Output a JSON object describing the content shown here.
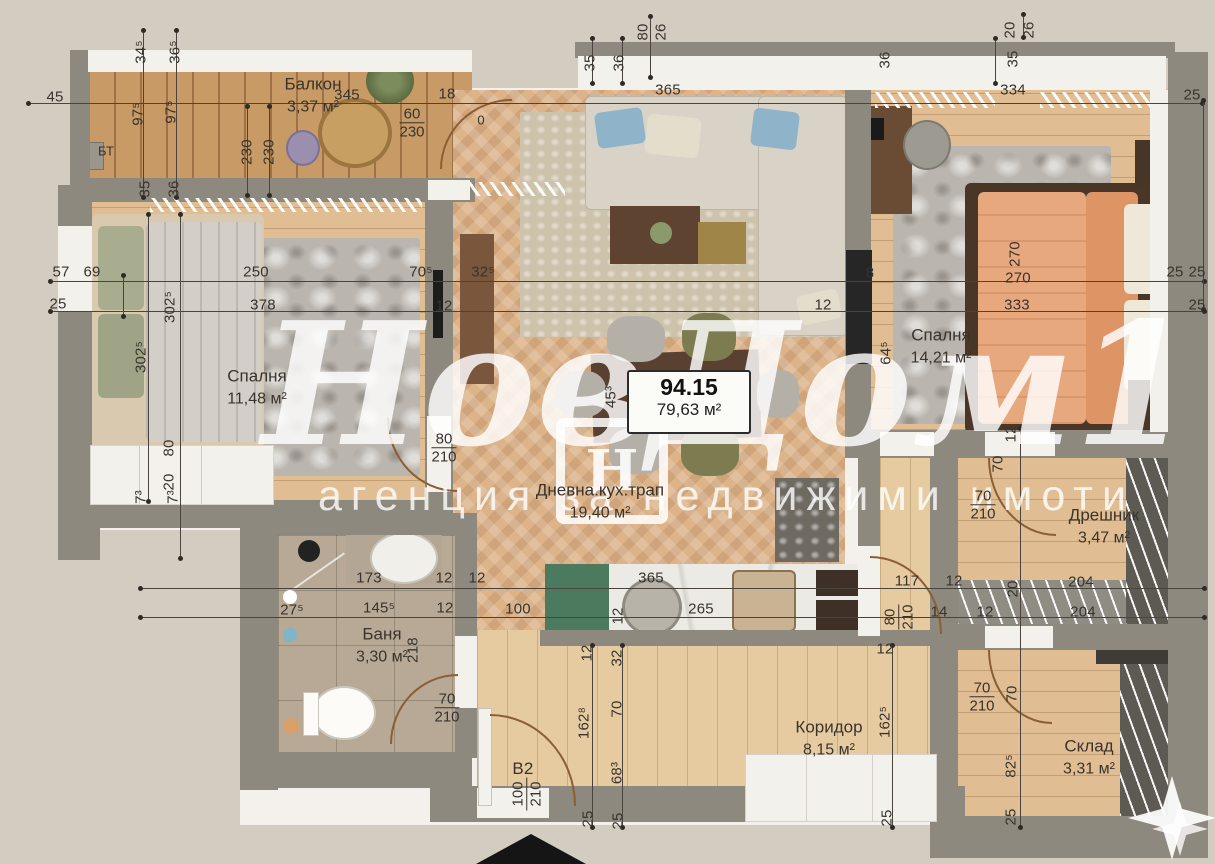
{
  "watermark": {
    "brand_left": "Нов",
    "brand_right": "Дом1",
    "logo_letter": "Н",
    "tagline": "агенция за недвижими имоти"
  },
  "summary": {
    "total": "94.15",
    "net": "79,63 м²"
  },
  "entrance": {
    "tag": "B2"
  },
  "rooms": [
    {
      "id": "balcony",
      "name": "Балкон",
      "area": "3,37 м²",
      "x": 313,
      "y": 96
    },
    {
      "id": "bedroom-left",
      "name": "Спалня",
      "area": "11,48 м²",
      "x": 257,
      "y": 388
    },
    {
      "id": "living",
      "name": "Дневна.кух.трап",
      "area": "19,40 м²",
      "x": 600,
      "y": 502
    },
    {
      "id": "bedroom-right",
      "name": "Спалня",
      "area": "14,21 м²",
      "x": 941,
      "y": 347
    },
    {
      "id": "bathroom",
      "name": "Баня",
      "area": "3,30 м²",
      "x": 382,
      "y": 646
    },
    {
      "id": "corridor",
      "name": "Коридор",
      "area": "8,15 м²",
      "x": 829,
      "y": 739
    },
    {
      "id": "closet",
      "name": "Дрешник",
      "area": "3,47 м²",
      "x": 1104,
      "y": 527
    },
    {
      "id": "storage",
      "name": "Склад",
      "area": "3,31 м²",
      "x": 1089,
      "y": 758
    }
  ],
  "annotations": [
    {
      "t": "БТ",
      "x": 106,
      "y": 151
    },
    {
      "t": "0",
      "x": 481,
      "y": 120
    }
  ],
  "dims": [
    {
      "t": "45",
      "x": 55,
      "y": 97
    },
    {
      "t": "345",
      "x": 347,
      "y": 95
    },
    {
      "t": "18",
      "x": 447,
      "y": 94
    },
    {
      "t": "365",
      "x": 668,
      "y": 90
    },
    {
      "t": "334",
      "x": 1013,
      "y": 90
    },
    {
      "t": "25",
      "x": 1192,
      "y": 95
    },
    {
      "t": "34⁵",
      "x": 141,
      "y": 52,
      "r": 1
    },
    {
      "t": "36⁵",
      "x": 175,
      "y": 52,
      "r": 1
    },
    {
      "t": "97⁵",
      "x": 138,
      "y": 114,
      "r": 1
    },
    {
      "t": "97⁵",
      "x": 171,
      "y": 112,
      "r": 1
    },
    {
      "t": "230",
      "x": 247,
      "y": 152,
      "r": 1
    },
    {
      "t": "230",
      "x": 269,
      "y": 152,
      "r": 1
    },
    {
      "t": "35",
      "x": 145,
      "y": 189,
      "r": 1
    },
    {
      "t": "36",
      "x": 174,
      "y": 189,
      "r": 1
    },
    {
      "t": "80",
      "x": 643,
      "y": 32,
      "r": 1
    },
    {
      "t": "26",
      "x": 661,
      "y": 32,
      "r": 1
    },
    {
      "t": "35",
      "x": 590,
      "y": 63,
      "r": 1
    },
    {
      "t": "36",
      "x": 619,
      "y": 63,
      "r": 1
    },
    {
      "t": "20",
      "x": 1010,
      "y": 30,
      "r": 1
    },
    {
      "t": "26",
      "x": 1029,
      "y": 30,
      "r": 1
    },
    {
      "t": "35",
      "x": 1013,
      "y": 59,
      "r": 1
    },
    {
      "t": "36",
      "x": 885,
      "y": 60,
      "r": 1
    },
    {
      "t": "57",
      "x": 61,
      "y": 272
    },
    {
      "t": "25",
      "x": 58,
      "y": 304
    },
    {
      "t": "69",
      "x": 92,
      "y": 272
    },
    {
      "t": "250",
      "x": 256,
      "y": 272
    },
    {
      "t": "378",
      "x": 263,
      "y": 305
    },
    {
      "t": "302⁵",
      "x": 170,
      "y": 307,
      "r": 1
    },
    {
      "t": "302⁵",
      "x": 141,
      "y": 357,
      "r": 1
    },
    {
      "t": "70⁵",
      "x": 421,
      "y": 272
    },
    {
      "t": "32⁵",
      "x": 483,
      "y": 272
    },
    {
      "t": "12",
      "x": 444,
      "y": 306
    },
    {
      "t": "80",
      "x": 169,
      "y": 448,
      "r": 1
    },
    {
      "t": "20",
      "x": 169,
      "y": 482,
      "r": 1
    },
    {
      "t": "7³",
      "x": 141,
      "y": 497,
      "r": 1
    },
    {
      "t": "7³",
      "x": 173,
      "y": 497,
      "r": 1
    },
    {
      "t": "173",
      "x": 369,
      "y": 578
    },
    {
      "t": "12",
      "x": 444,
      "y": 578
    },
    {
      "t": "12",
      "x": 477,
      "y": 578
    },
    {
      "t": "27⁵",
      "x": 292,
      "y": 610
    },
    {
      "t": "145⁵",
      "x": 379,
      "y": 608
    },
    {
      "t": "12",
      "x": 445,
      "y": 608
    },
    {
      "t": "100",
      "x": 518,
      "y": 609
    },
    {
      "t": "218",
      "x": 413,
      "y": 650,
      "r": 1
    },
    {
      "t": "365",
      "x": 651,
      "y": 578
    },
    {
      "t": "265",
      "x": 701,
      "y": 609
    },
    {
      "t": "12",
      "x": 827,
      "y": 583
    },
    {
      "t": "12",
      "x": 618,
      "y": 616,
      "r": 1
    },
    {
      "t": "12",
      "x": 587,
      "y": 653,
      "r": 1
    },
    {
      "t": "32",
      "x": 617,
      "y": 658,
      "r": 1
    },
    {
      "t": "70",
      "x": 617,
      "y": 709,
      "r": 1
    },
    {
      "t": "162⁸",
      "x": 584,
      "y": 723,
      "r": 1
    },
    {
      "t": "68³",
      "x": 617,
      "y": 773,
      "r": 1
    },
    {
      "t": "25",
      "x": 588,
      "y": 819,
      "r": 1
    },
    {
      "t": "25",
      "x": 618,
      "y": 821,
      "r": 1
    },
    {
      "t": "117",
      "x": 907,
      "y": 581
    },
    {
      "t": "12",
      "x": 954,
      "y": 581
    },
    {
      "t": "14",
      "x": 939,
      "y": 612
    },
    {
      "t": "12",
      "x": 985,
      "y": 612
    },
    {
      "t": "204",
      "x": 1081,
      "y": 582
    },
    {
      "t": "204",
      "x": 1083,
      "y": 612
    },
    {
      "t": "20",
      "x": 1013,
      "y": 589,
      "r": 1
    },
    {
      "t": "12",
      "x": 885,
      "y": 649
    },
    {
      "t": "12",
      "x": 1011,
      "y": 434,
      "r": 1
    },
    {
      "t": "70",
      "x": 998,
      "y": 464,
      "r": 1
    },
    {
      "t": "45³",
      "x": 611,
      "y": 397,
      "r": 1
    },
    {
      "t": "270",
      "x": 1015,
      "y": 254,
      "r": 1
    },
    {
      "t": "270",
      "x": 1018,
      "y": 278
    },
    {
      "t": "333",
      "x": 1017,
      "y": 305
    },
    {
      "t": "8",
      "x": 870,
      "y": 273
    },
    {
      "t": "12",
      "x": 823,
      "y": 305
    },
    {
      "t": "64⁵",
      "x": 886,
      "y": 353,
      "r": 1
    },
    {
      "t": "25",
      "x": 1175,
      "y": 272
    },
    {
      "t": "25",
      "x": 1197,
      "y": 272
    },
    {
      "t": "25",
      "x": 1197,
      "y": 305
    },
    {
      "t": "70",
      "x": 1012,
      "y": 694,
      "r": 1
    },
    {
      "t": "82⁵",
      "x": 1011,
      "y": 766,
      "r": 1
    },
    {
      "t": "25",
      "x": 1011,
      "y": 817,
      "r": 1
    },
    {
      "t": "162⁵",
      "x": 885,
      "y": 722,
      "r": 1
    },
    {
      "t": "25",
      "x": 887,
      "y": 818,
      "r": 1
    }
  ],
  "door_sizes": [
    {
      "top": "60",
      "bottom": "230",
      "x": 412,
      "y": 123
    },
    {
      "top": "80",
      "bottom": "210",
      "x": 444,
      "y": 448
    },
    {
      "top": "70",
      "bottom": "210",
      "x": 447,
      "y": 708
    },
    {
      "top": "70",
      "bottom": "210",
      "x": 983,
      "y": 505
    },
    {
      "top": "70",
      "bottom": "210",
      "x": 982,
      "y": 697
    },
    {
      "top": "80",
      "bottom": "210",
      "x": 899,
      "y": 617,
      "r": 1
    },
    {
      "top": "100",
      "bottom": "210",
      "x": 527,
      "y": 794,
      "r": 1
    }
  ],
  "colors": {
    "background": "#d3ccc0",
    "wall": "#8e897e",
    "wood_living": "#ddb48a",
    "wood_balcony": "#c79a66",
    "kitchen_green": "#4c7a5e",
    "bed_orange": "#e8a87e"
  }
}
